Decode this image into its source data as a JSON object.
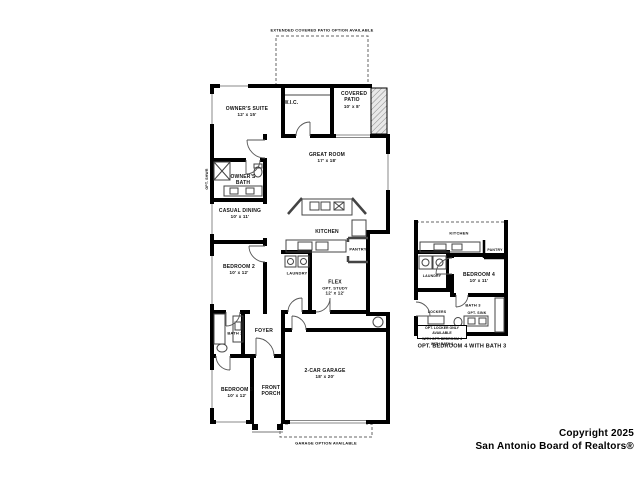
{
  "colors": {
    "background": "#ffffff",
    "wall": "#000000",
    "thin_line": "#555555",
    "hatch": "#aaaaaa"
  },
  "main_plan": {
    "option_notes": {
      "extended_patio": "EXTENDED COVERED PATIO OPTION AVAILABLE",
      "garage": "GARAGE OPTION AVAILABLE"
    },
    "rooms": {
      "owners_suite": {
        "label": "OWNER'S SUITE",
        "dims": "12' x 15'"
      },
      "wic": {
        "label": "W.I.C."
      },
      "covered_patio": {
        "label": "COVERED PATIO",
        "dims": "10' x 8'"
      },
      "great_room": {
        "label": "GREAT ROOM",
        "dims": "17' x 18'"
      },
      "owners_bath": {
        "label": "OWNER'S BATH"
      },
      "opt_shwr": {
        "label": "OPT. SHWR"
      },
      "casual_dining": {
        "label": "CASUAL DINING",
        "dims": "10' x 11'"
      },
      "kitchen": {
        "label": "KITCHEN"
      },
      "pantry": {
        "label": "PANTRY"
      },
      "bedroom_2": {
        "label": "BEDROOM 2",
        "dims": "10' x 12'"
      },
      "laundry": {
        "label": "LAUNDRY"
      },
      "flex": {
        "label": "FLEX",
        "sub": "OPT. STUDY",
        "dims": "12' x 12'"
      },
      "bath_2": {
        "label": "BATH 2"
      },
      "foyer": {
        "label": "FOYER"
      },
      "bedroom_3": {
        "label": "BEDROOM 3",
        "dims": "10' x 12'"
      },
      "front_porch": {
        "label": "FRONT PORCH"
      },
      "garage": {
        "label": "2-CAR GARAGE",
        "dims": "18' x 20'"
      }
    }
  },
  "inset_plan": {
    "caption": "OPT. BEDROOM 4 WITH BATH 3",
    "note_line1": "OPT. LOCKER ONLY AVAILABLE",
    "note_line2": "WITH OPT. BEDROOM 4 WITH BATH 3",
    "rooms": {
      "kitchen": {
        "label": "KITCHEN"
      },
      "pantry": {
        "label": "PANTRY"
      },
      "laundry": {
        "label": "LAUNDRY"
      },
      "bedroom_4": {
        "label": "BEDROOM 4",
        "dims": "10' x 11'"
      },
      "bath_3": {
        "label": "BATH 3"
      },
      "opt_sink": {
        "label": "OPT. SINK"
      },
      "lockers": {
        "label": "LOCKERS"
      }
    }
  },
  "footer": {
    "copyright_line1": "Copyright 2025",
    "copyright_line2": "San Antonio Board of Realtors®"
  }
}
